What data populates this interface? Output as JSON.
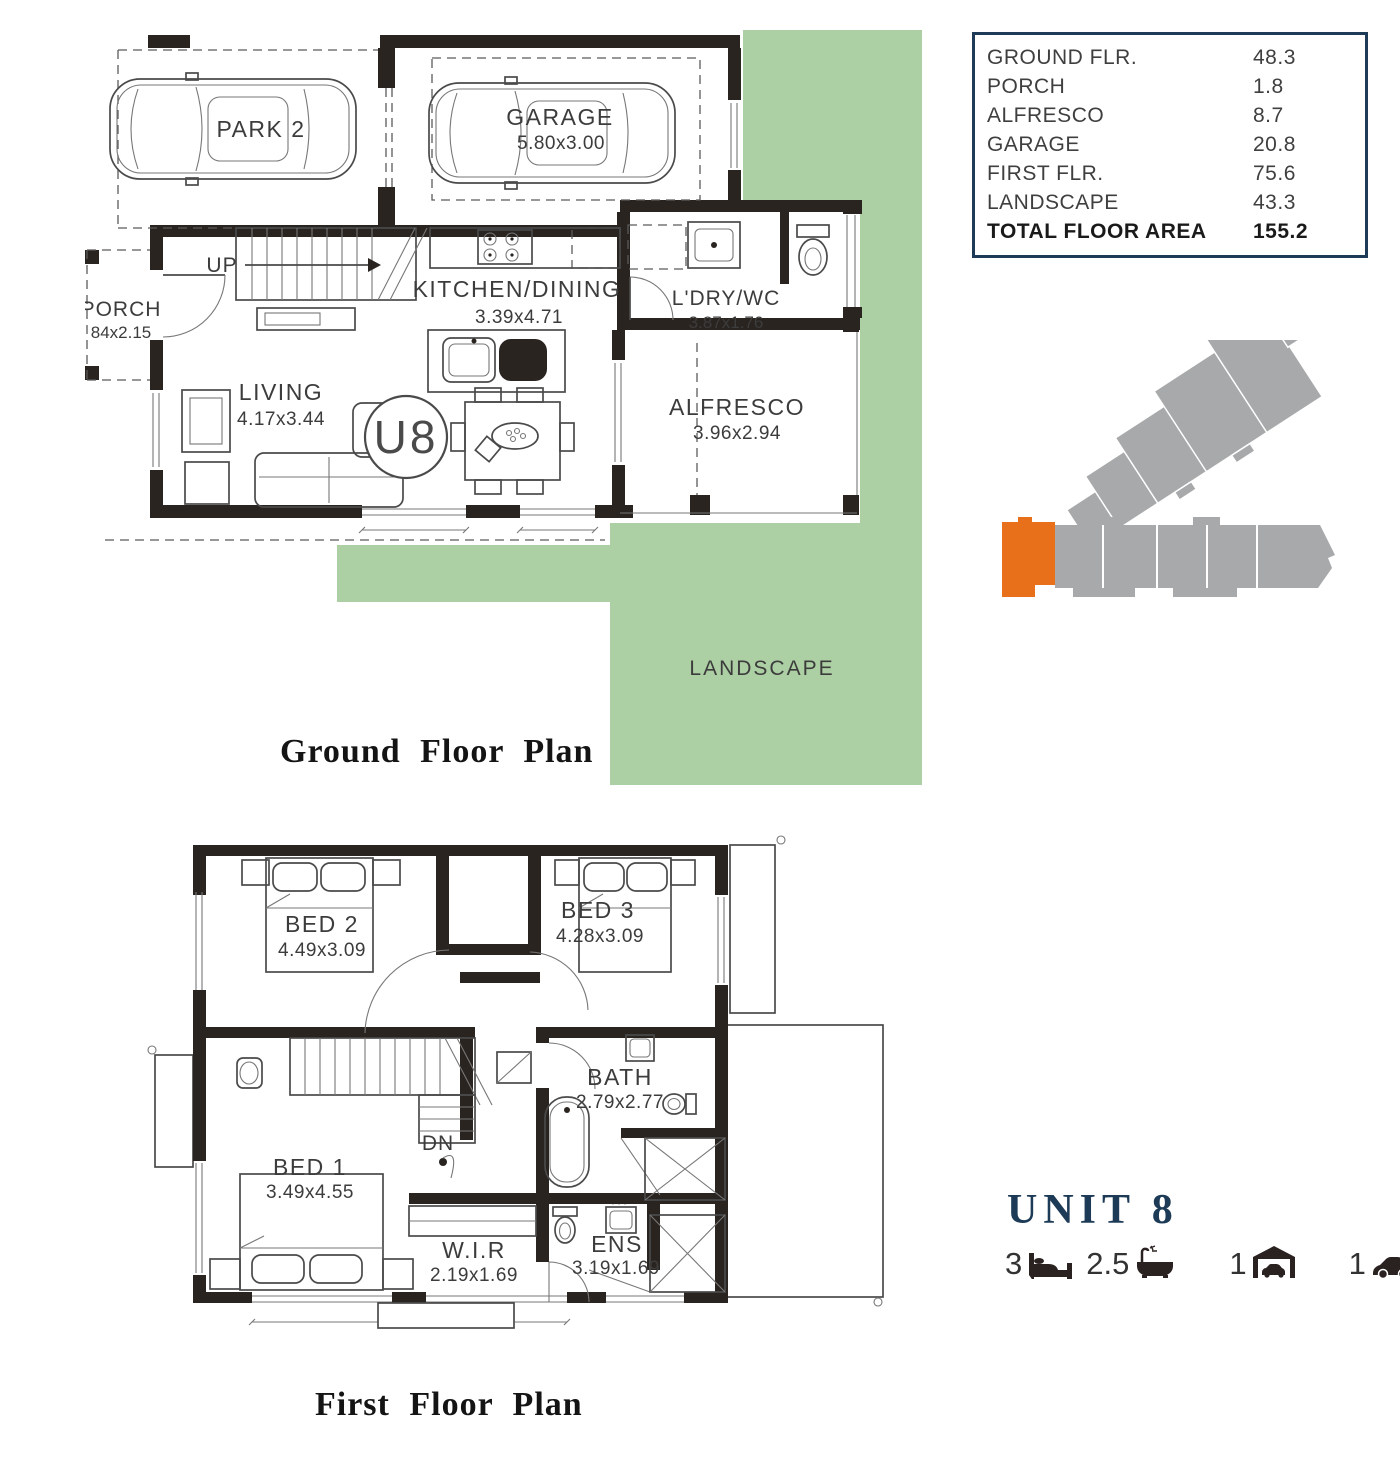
{
  "area_table": {
    "rows": [
      {
        "label": "GROUND FLR.",
        "value": "48.3"
      },
      {
        "label": "PORCH",
        "value": "1.8"
      },
      {
        "label": "ALFRESCO",
        "value": "8.7"
      },
      {
        "label": "GARAGE",
        "value": "20.8"
      },
      {
        "label": "FIRST FLR.",
        "value": "75.6"
      },
      {
        "label": "LANDSCAPE",
        "value": "43.3"
      },
      {
        "label": "TOTAL FLOOR AREA",
        "value": "155.2"
      }
    ]
  },
  "ground_floor": {
    "title": "Ground Floor Plan",
    "unit_badge": "U8",
    "stairs_label": "UP",
    "landscape_label": "LANDSCAPE",
    "rooms": [
      {
        "name": "PARK 2",
        "dims": ""
      },
      {
        "name": "GARAGE",
        "dims": "5.80x3.00"
      },
      {
        "name": "PORCH",
        "dims": "84x2.15"
      },
      {
        "name": "KITCHEN/DINING",
        "dims": "3.39x4.71"
      },
      {
        "name": "L'DRY/WC",
        "dims": "3.87x1.76"
      },
      {
        "name": "LIVING",
        "dims": "4.17x3.44"
      },
      {
        "name": "ALFRESCO",
        "dims": "3.96x2.94"
      }
    ]
  },
  "first_floor": {
    "title": "First Floor Plan",
    "stairs_label": "DN",
    "rooms": [
      {
        "name": "BED 2",
        "dims": "4.49x3.09"
      },
      {
        "name": "BED 3",
        "dims": "4.28x3.09"
      },
      {
        "name": "BATH",
        "dims": "2.79x2.77"
      },
      {
        "name": "BED 1",
        "dims": "3.49x4.55"
      },
      {
        "name": "W.I.R",
        "dims": "2.19x1.69"
      },
      {
        "name": "ENS",
        "dims": "3.19x1.69"
      }
    ]
  },
  "unit_info": {
    "title": "UNIT 8",
    "specs": [
      {
        "value": "3",
        "icon": "bed-icon"
      },
      {
        "value": "2.5",
        "icon": "bath-icon"
      },
      {
        "value": "1",
        "icon": "garage-icon"
      },
      {
        "value": "1",
        "icon": "car-icon"
      }
    ]
  },
  "colors": {
    "landscape_green": "#adcfa4",
    "highlight_orange": "#e8701a",
    "building_gray": "#a7a9aa",
    "navy": "#1d3b57",
    "wall_dark": "#2a2420"
  }
}
